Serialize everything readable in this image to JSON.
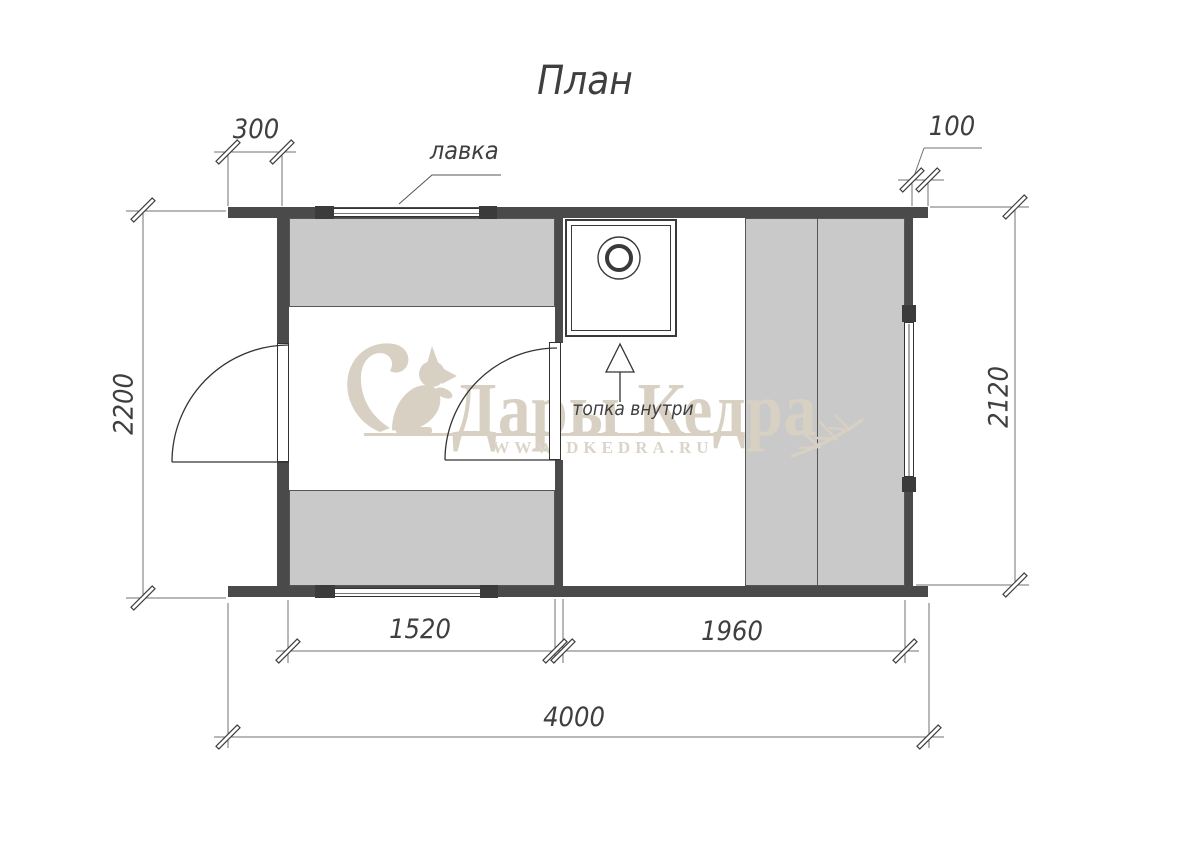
{
  "title": "План",
  "labels": {
    "bench_callout": "лавка",
    "stove_note": "топка внутри"
  },
  "dimensions": {
    "left_overhang": "300",
    "right_overhang": "100",
    "left_height": "2200",
    "right_interior_height": "2120",
    "room_left_width": "1520",
    "room_right_width": "1960",
    "total_width": "4000"
  },
  "watermark": {
    "brand": "Дары Кедра",
    "url": "WWW.DKEDRA.RU"
  },
  "colors": {
    "wall": "#4a4a4a",
    "bench_fill": "#c9c9c9",
    "window_cap": "#3b3b3b",
    "plan_line": "#333333",
    "dimension_line": "#707070",
    "text": "#3f3f3f",
    "watermark": "#d8d0c3",
    "background": "#ffffff"
  }
}
